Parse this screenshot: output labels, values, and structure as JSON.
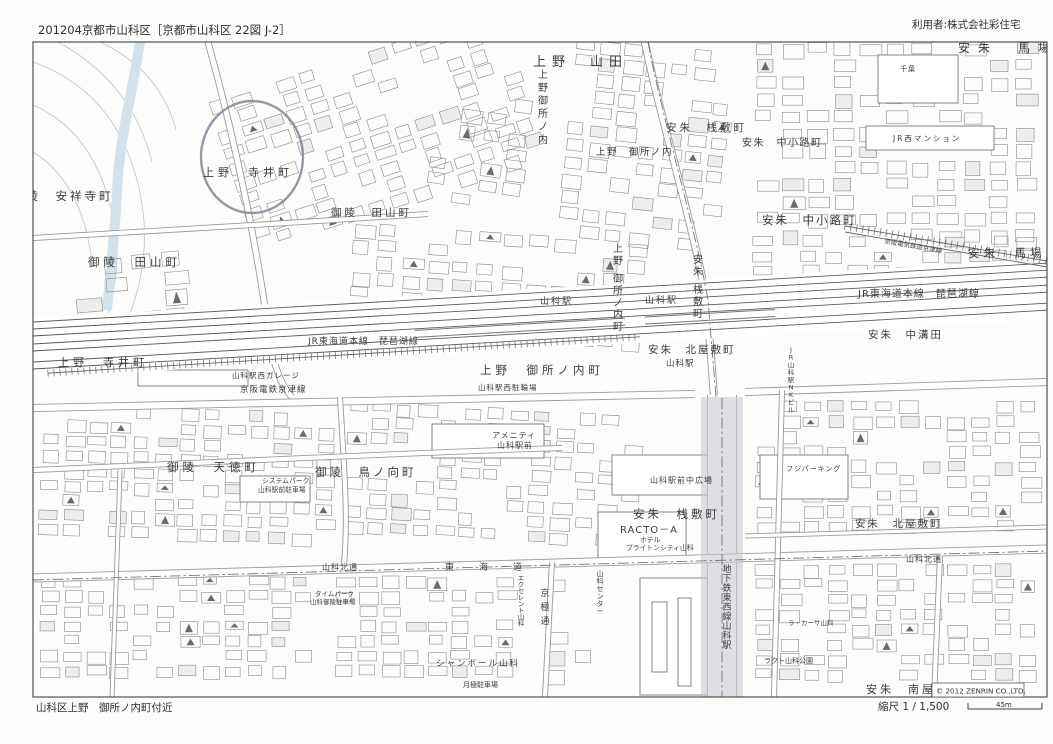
{
  "header": {
    "left": "201204京都市山科区［京都市山科区 22図 J-2］",
    "right": "利用者:株式会社彩住宅"
  },
  "footer": {
    "left": "山科区上野　御所ノ内町付近",
    "scale_label": "縮尺 1 / 1,500",
    "scale_distance": "45m",
    "copyright": "© 2012 ZENRIN CO.,LTD."
  },
  "colors": {
    "river": "#dfeaf2",
    "subway_band": "#c7cad0",
    "annotation_circle": "#7e8698",
    "rail_line": "#5a5a5a",
    "road_casing": "#9a9a9a",
    "building_outline": "#8b8b8b"
  },
  "map_labels": [
    {
      "id": "ueno-yamada",
      "text": "上野　山田"
    },
    {
      "id": "anshu-baba-ne",
      "text": "安朱　馬場"
    },
    {
      "id": "anshu-sajiki-top",
      "text": "安朱　桟敷町"
    },
    {
      "id": "ueno-gosho-top",
      "text": "上野　御所ノ内"
    },
    {
      "id": "anshu-nakakoji-1",
      "text": "安朱　中小路町"
    },
    {
      "id": "anshu-nakakoji-2",
      "text": "安朱　中小路町"
    },
    {
      "id": "goryo-anshoji",
      "text": "御陵　安祥寺町"
    },
    {
      "id": "ueno-terai-1",
      "text": "上野　寺井町"
    },
    {
      "id": "goryo-tayama-1",
      "text": "御陵　田山町"
    },
    {
      "id": "goryo-tayama-2",
      "text": "御陵　田山町"
    },
    {
      "id": "jr-tokaido-r",
      "text": "JR東海道本線　琵琶湖線"
    },
    {
      "id": "jr-tokaido-l",
      "text": "JR東海道本線　琵琶湖線"
    },
    {
      "id": "sta-1",
      "text": "山科駅"
    },
    {
      "id": "sta-2",
      "text": "山科駅"
    },
    {
      "id": "sta-3",
      "text": "山科駅"
    },
    {
      "id": "ueno-gosho-v1",
      "text": "上野御所ノ内"
    },
    {
      "id": "ueno-gosho-v2",
      "text": "上野　御所ノ内町"
    },
    {
      "id": "anshu-sajiki-v",
      "text": "安朱　桟敷町"
    },
    {
      "id": "ueno-gosho-h",
      "text": "上野　御所ノ内町"
    },
    {
      "id": "cycle-park",
      "text": "山科駅西駐輪場"
    },
    {
      "id": "anshu-kitayashiki-1",
      "text": "安朱　北屋敷町"
    },
    {
      "id": "ueno-terai-2",
      "text": "上野　寺井町"
    },
    {
      "id": "west-garage",
      "text": "山科駅西ガレージ"
    },
    {
      "id": "keihan-l",
      "text": "京阪電鉄京津線"
    },
    {
      "id": "anshu-nakamizota",
      "text": "安朱　中溝田"
    },
    {
      "id": "nk-bldg",
      "text": "JR山科駅NKビル"
    },
    {
      "id": "amenity-1",
      "text": "アメニティ"
    },
    {
      "id": "amenity-2",
      "text": "山科駅前"
    },
    {
      "id": "goryo-tentoku",
      "text": "御陵　天徳町"
    },
    {
      "id": "goryo-torinomukai",
      "text": "御陵　鳥ノ向町"
    },
    {
      "id": "system-park-1",
      "text": "システムパーク"
    },
    {
      "id": "system-park-2",
      "text": "山科駅前駐車場"
    },
    {
      "id": "plaza",
      "text": "山科駅前中広場"
    },
    {
      "id": "anshu-sajiki-2",
      "text": "安朱　桟敷町"
    },
    {
      "id": "racto",
      "text": "RACTO－A"
    },
    {
      "id": "hotel-1",
      "text": "ホテル"
    },
    {
      "id": "hotel-2",
      "text": "ブライトンシティ山科"
    },
    {
      "id": "fuji-parking",
      "text": "フジパーキング"
    },
    {
      "id": "anshu-kitayashiki-2",
      "text": "安朱　北屋敷町"
    },
    {
      "id": "subway-v",
      "text": "地下鉄東西線山科駅"
    },
    {
      "id": "center-v",
      "text": "山科センター"
    },
    {
      "id": "la-casa",
      "text": "ラ・カーサ山科"
    },
    {
      "id": "racto-park",
      "text": "ラクト山科公園"
    },
    {
      "id": "kita-dori-1",
      "text": "山科北通"
    },
    {
      "id": "tokaido-road",
      "text": "東　海　道"
    },
    {
      "id": "kita-dori-2",
      "text": "山科北通"
    },
    {
      "id": "chanbord",
      "text": "シャンボール山科"
    },
    {
      "id": "tsukigime",
      "text": "月極駐車場"
    },
    {
      "id": "kyogoku-v",
      "text": "京極通"
    },
    {
      "id": "excellent-v",
      "text": "エクセレント山科"
    },
    {
      "id": "time-park-1",
      "text": "タイムパーク"
    },
    {
      "id": "time-park-2",
      "text": "山科御陵駐車場"
    },
    {
      "id": "anshu-baba-e",
      "text": "安朱　馬場"
    },
    {
      "id": "keihan-diag",
      "text": "京阪電気鉄道京津線"
    },
    {
      "id": "anshu-minamiyashiki",
      "text": "安朱　南屋敷町"
    },
    {
      "id": "chiba",
      "text": "千葉"
    },
    {
      "id": "mansion",
      "text": "JR西マンション"
    }
  ]
}
